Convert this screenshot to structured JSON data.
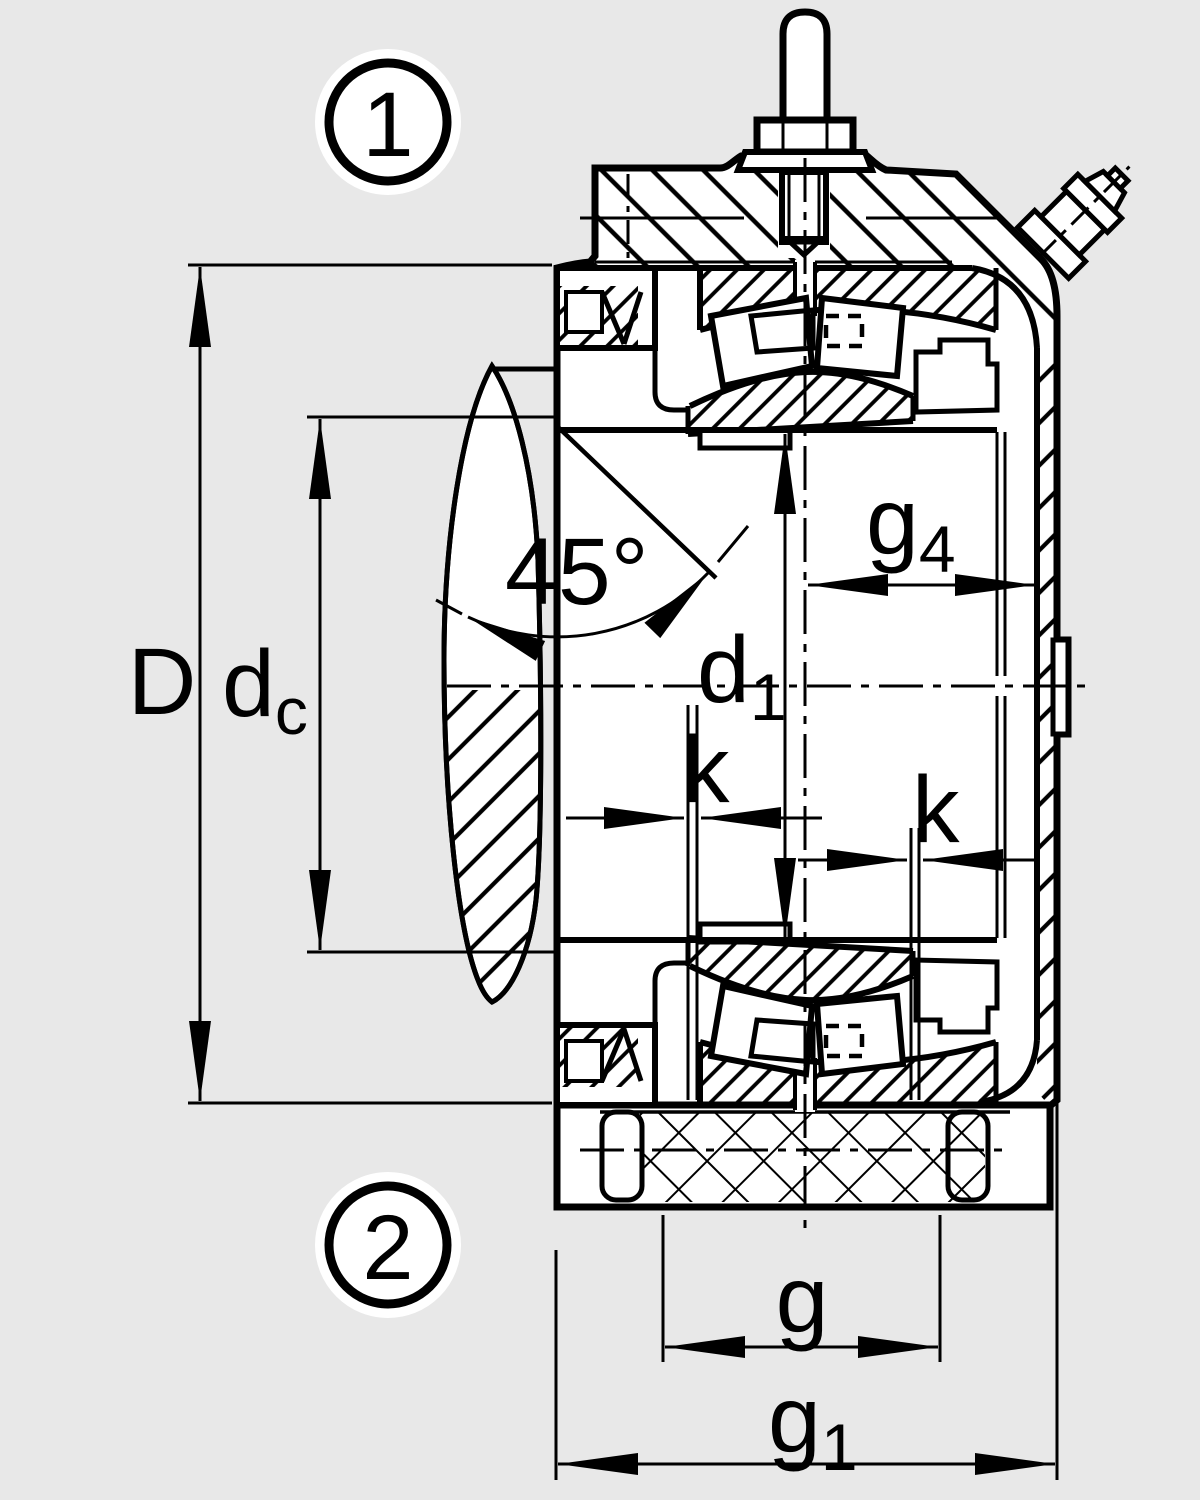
{
  "drawing": {
    "description": "Sectional technical drawing of a plummer block housing unit with spherical roller bearing, shaft, eye bolt and lubrication nipple",
    "background_color": "#e8e8e8",
    "line_color": "#000000",
    "part_fill_color": "#ffffff",
    "callouts": {
      "top": "1",
      "bottom": "2"
    },
    "labels": {
      "outer": "D",
      "cap": {
        "base": "d",
        "sub": "c"
      },
      "angle": "45°",
      "bore": {
        "base": "d",
        "sub": "1"
      },
      "g4": {
        "base": "g",
        "sub": "4"
      },
      "k_upper": "k",
      "k_lower": "k",
      "g": "g",
      "g1": {
        "base": "g",
        "sub": "1"
      }
    }
  }
}
